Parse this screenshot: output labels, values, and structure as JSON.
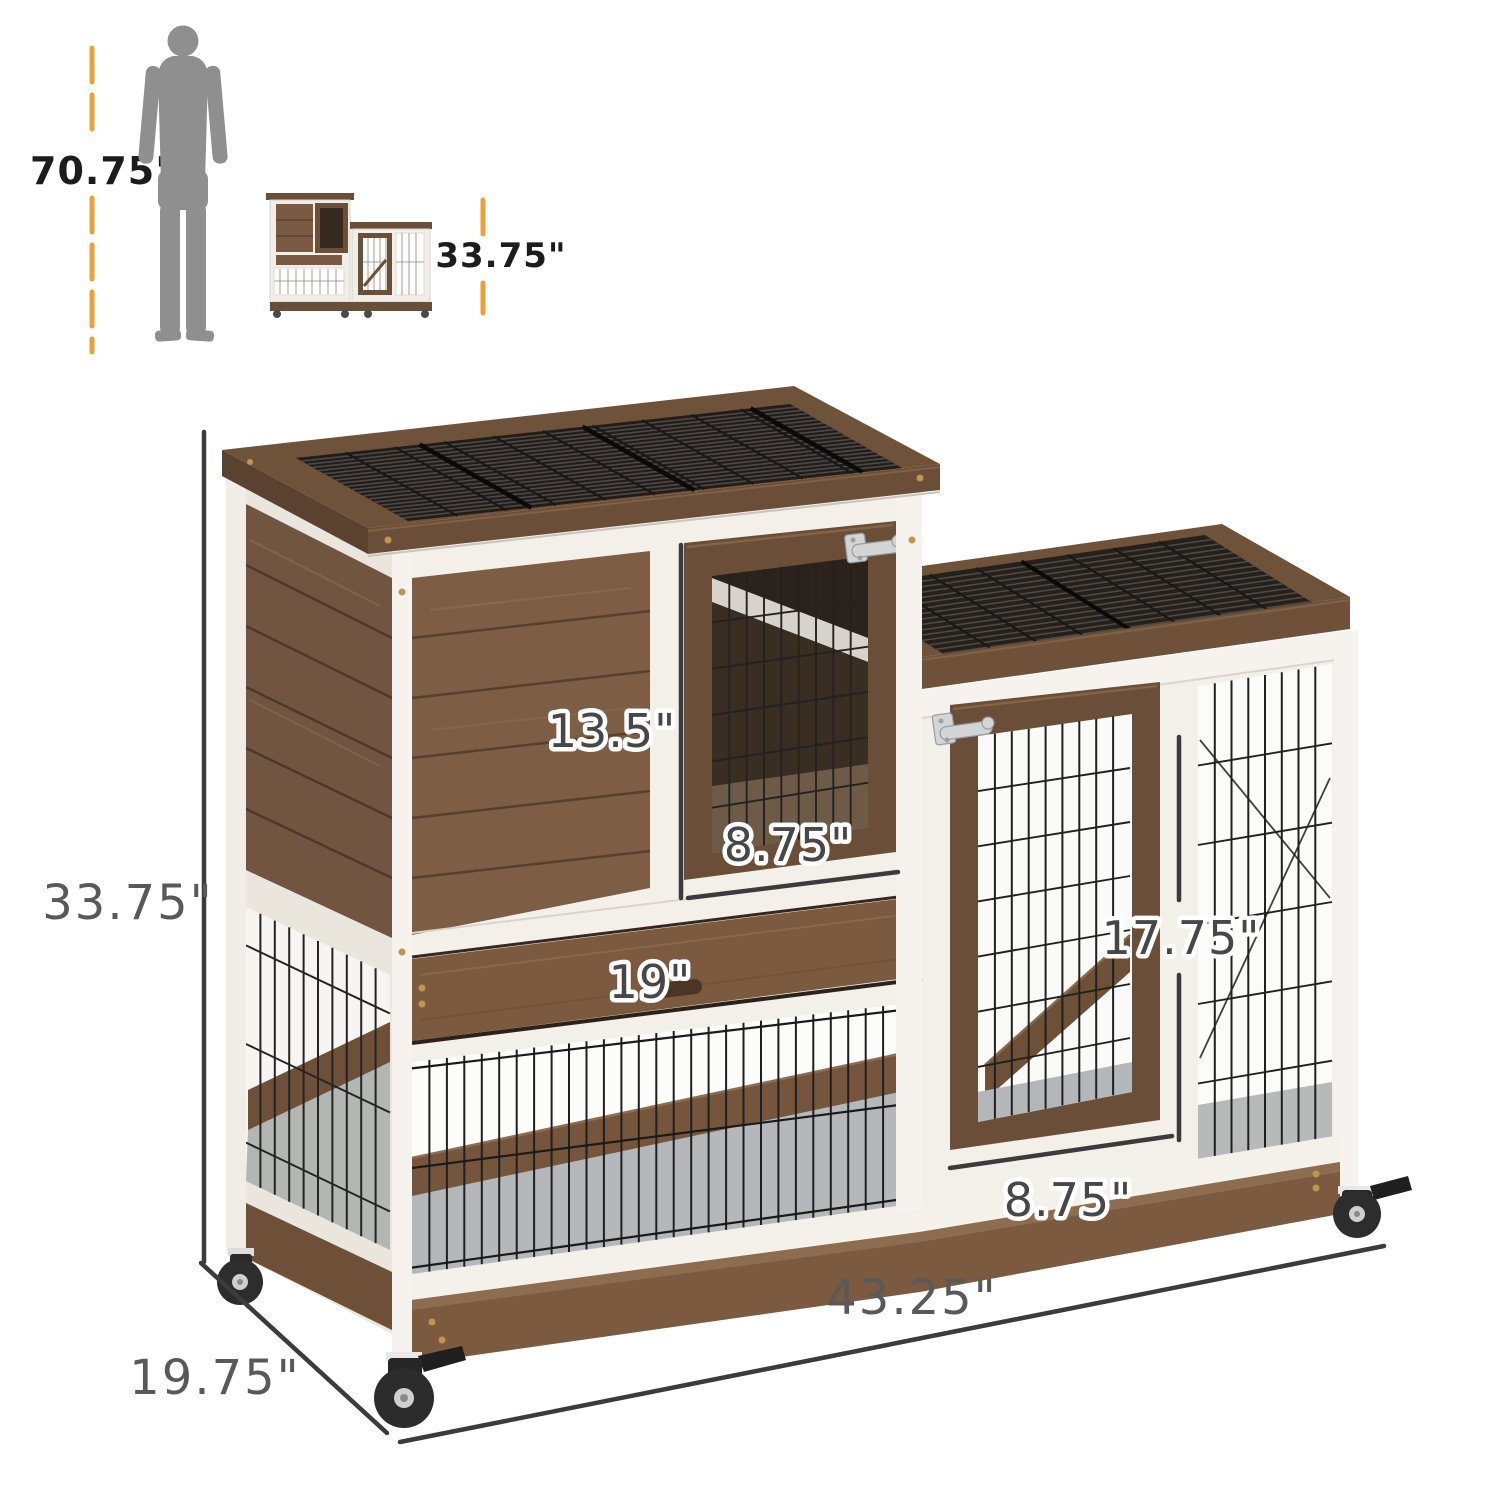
{
  "title": "Indoor rabbit hutch dimension diagram",
  "size_reference": {
    "human_height": "70.75\"",
    "product_height": "33.75\""
  },
  "product_dimensions": {
    "overall_height": "33.75\"",
    "overall_width": "43.25\"",
    "overall_depth": "19.75\"",
    "upper_door_height": "13.5\"",
    "upper_door_width": "8.75\"",
    "tray_width": "19\"",
    "side_door_height": "17.75\"",
    "side_door_width": "8.75\""
  },
  "colors": {
    "accent_orange": "#E9A23B",
    "dimension_line": "#3B3B3B",
    "label_gray": "#474747",
    "wood_brown": "#7B5A40",
    "wood_dark": "#5D4330",
    "trim_white": "#F3F0EA",
    "wire_black": "#1E1E1E",
    "silhouette_gray": "#8F8F8F",
    "background": "#FFFFFF"
  }
}
